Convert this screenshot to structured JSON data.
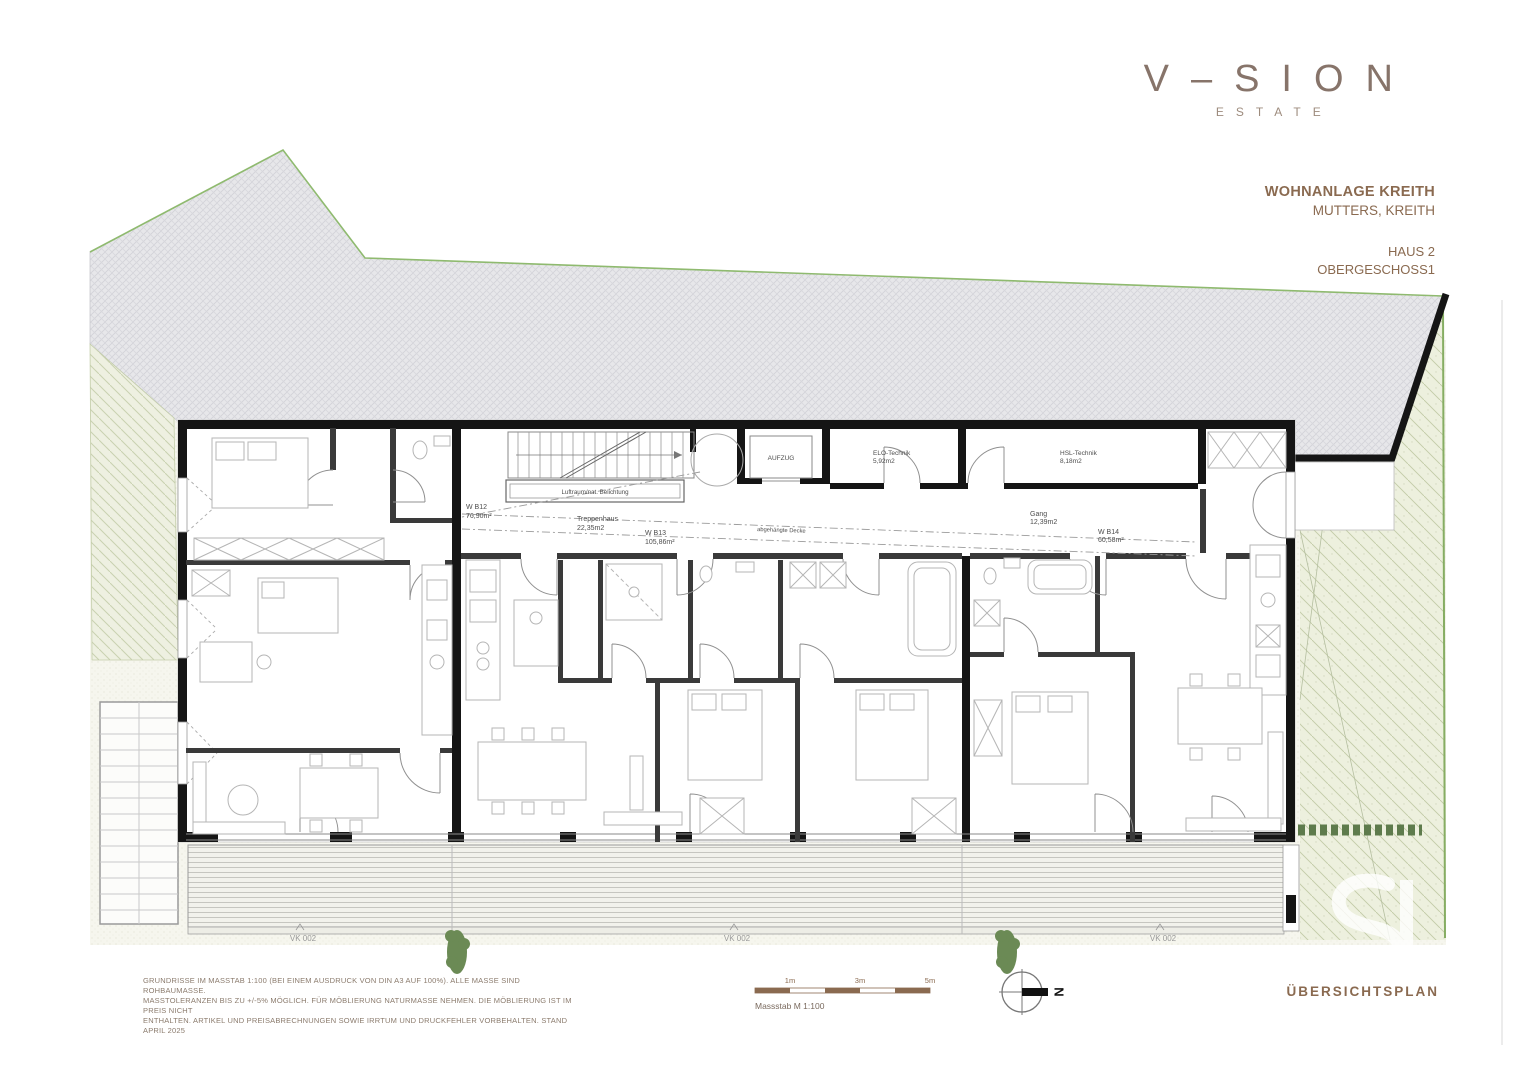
{
  "brand": {
    "logo_text": "V–SION",
    "logo_sub": "ESTATE"
  },
  "title_block": {
    "project": "WOHNANLAGE KREITH",
    "location": "MUTTERS, KREITH",
    "building": "HAUS 2",
    "floor": "OBERGESCHOSS1"
  },
  "plan": {
    "rooms": [
      {
        "id": "wb12",
        "label": "W B12",
        "area": "76,90m²"
      },
      {
        "id": "treppenhaus",
        "label": "Treppenhaus",
        "area": "22,35m2"
      },
      {
        "id": "wb13",
        "label": "W B13",
        "area": "105,86m²"
      },
      {
        "id": "aufzug",
        "label": "AUFZUG"
      },
      {
        "id": "elo-technik",
        "label": "ELO-Technik",
        "area": "5,92m2"
      },
      {
        "id": "hsl-technik",
        "label": "HSL-Technik",
        "area": "8,18m2"
      },
      {
        "id": "gang",
        "label": "Gang",
        "area": "12,39m2"
      },
      {
        "id": "wb14",
        "label": "W B14",
        "area": "60,58m²"
      }
    ],
    "annotations": {
      "skylight": "Luftraum/nat. Belichtung",
      "ceiling": "abgehängte Decke"
    },
    "terrace_marks": [
      "VK 002",
      "VK 002",
      "VK 002"
    ]
  },
  "scale_bar": {
    "ticks": [
      "1m",
      "3m",
      "5m"
    ],
    "caption": "Massstab M 1:100"
  },
  "compass": {
    "north_label": "N"
  },
  "footer": {
    "disclaimer_lines": [
      "GRUNDRISSE IM MASSTAB 1:100 (BEI EINEM AUSDRUCK VON DIN A3 AUF 100%). ALLE MASSE SIND ROHBAUMASSE.",
      "MASSTOLERANZEN BIS ZU +/-5% MÖGLICH. FÜR MÖBLIERUNG NATURMASSE NEHMEN. DIE MÖBLIERUNG IST IM PREIS NICHT",
      "ENTHALTEN. ARTIKEL UND PREISABRECHNUNGEN SOWIE IRRTUM UND DRUCKFEHLER VORBEHALTEN. STAND APRIL 2025"
    ],
    "plan_type": "ÜBERSICHTSPLAN"
  },
  "colors": {
    "brand": "#87746a",
    "accent_brown": "#8a6a50",
    "wall_black": "#151515",
    "site_green_line": "#8fba6f",
    "hedge_green": "#5e7b4c"
  }
}
